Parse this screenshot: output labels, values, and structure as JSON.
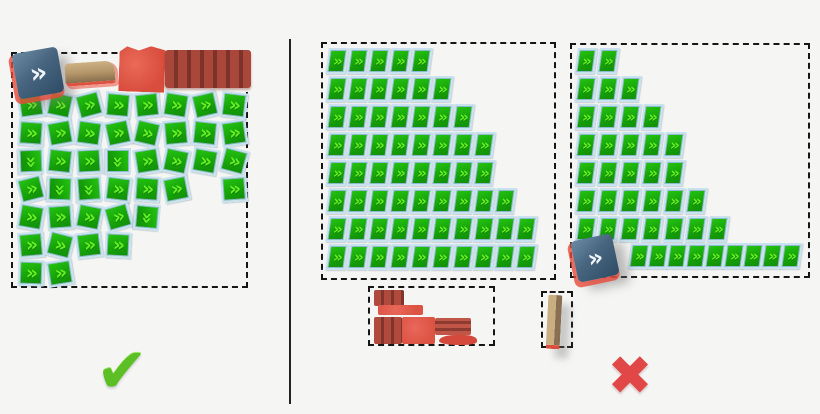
{
  "figure": {
    "width": 820,
    "height": 414,
    "background": "#f5f5f4"
  },
  "divider": {
    "x": 289,
    "y": 39,
    "height": 365,
    "color": "#222222"
  },
  "tile_style": {
    "glyph": "»",
    "green_dark": "#17a30a",
    "green_light": "#66ef24",
    "frame_color": "#c9e3ee",
    "edge_color": "#8fb9cd"
  },
  "icons": {
    "blue_chevron": {
      "glyph": "»",
      "bg_top": "#6a8ba3",
      "bg_bottom": "#2e4c66",
      "fg": "#eef4f8",
      "outline": "#e84a3a"
    },
    "check": {
      "glyph": "✔",
      "color": "#5bbf25"
    },
    "cross": {
      "glyph": "✖",
      "color": "#e14747"
    }
  },
  "left_panel": {
    "meaning": "correct-arrangement",
    "box": {
      "x": 11,
      "y": 52,
      "w": 237,
      "h": 236
    },
    "tile_origin": {
      "x": 5,
      "y": 38
    },
    "step": {
      "x": 29,
      "y": 28
    },
    "specials": [
      {
        "name": "blue-chevron-tile",
        "type": "blue",
        "x": 2,
        "y": -4,
        "w": 46,
        "h": 46,
        "rot": -10
      },
      {
        "name": "tan-wedge",
        "type": "tan",
        "x": 52,
        "y": 8,
        "w": 50,
        "h": 20,
        "rot": -4
      },
      {
        "name": "red-block",
        "type": "red",
        "x": 106,
        "y": -8,
        "w": 46,
        "h": 46,
        "rot": 2
      },
      {
        "name": "red-striped-block",
        "type": "red-striped",
        "x": 152,
        "y": -4,
        "w": 86,
        "h": 38,
        "rot": 0
      }
    ],
    "tiles": [
      [
        0,
        0,
        -8
      ],
      [
        0,
        1,
        4
      ],
      [
        0,
        2,
        88
      ],
      [
        0,
        3,
        -14
      ],
      [
        0,
        4,
        10
      ],
      [
        0,
        5,
        -5
      ],
      [
        0,
        6,
        2
      ],
      [
        1,
        0,
        12
      ],
      [
        1,
        1,
        -10
      ],
      [
        1,
        2,
        6
      ],
      [
        1,
        3,
        92
      ],
      [
        1,
        4,
        -4
      ],
      [
        1,
        5,
        14
      ],
      [
        1,
        6,
        -9
      ],
      [
        2,
        0,
        -15
      ],
      [
        2,
        1,
        8
      ],
      [
        2,
        2,
        -3
      ],
      [
        2,
        3,
        86
      ],
      [
        2,
        4,
        11
      ],
      [
        2,
        5,
        -7
      ],
      [
        3,
        0,
        5
      ],
      [
        3,
        1,
        -12
      ],
      [
        3,
        2,
        90
      ],
      [
        3,
        3,
        7
      ],
      [
        3,
        4,
        -16
      ],
      [
        3,
        5,
        3
      ],
      [
        4,
        0,
        -6
      ],
      [
        4,
        1,
        13
      ],
      [
        4,
        2,
        -9
      ],
      [
        4,
        3,
        4
      ],
      [
        4,
        4,
        95
      ],
      [
        5,
        0,
        9
      ],
      [
        5,
        1,
        -5
      ],
      [
        5,
        2,
        12
      ],
      [
        5,
        3,
        -11
      ],
      [
        6,
        0,
        -13
      ],
      [
        6,
        1,
        6
      ],
      [
        6,
        2,
        10
      ],
      [
        7,
        0,
        7
      ],
      [
        7,
        1,
        -8
      ],
      [
        7,
        2,
        15
      ],
      [
        7,
        3,
        -4
      ]
    ]
  },
  "right_panel_a": {
    "meaning": "incorrect-arrangement-rows",
    "box": {
      "x": 321,
      "y": 42,
      "w": 235,
      "h": 238
    },
    "origin": {
      "x": 4,
      "y": 4
    },
    "step": {
      "x": 21,
      "y": 28
    },
    "rows": [
      5,
      6,
      7,
      8,
      8,
      9,
      10,
      10
    ]
  },
  "right_panel_b": {
    "meaning": "incorrect-arrangement-triangle",
    "box": {
      "x": 570,
      "y": 43,
      "w": 240,
      "h": 235
    },
    "origin": {
      "x": 4,
      "y": 3
    },
    "step": {
      "x": 22,
      "y": 28
    },
    "rows": [
      2,
      3,
      4,
      5,
      5,
      6,
      7
    ],
    "bottom_row": {
      "count": 9,
      "x": 57,
      "y": 198,
      "step": 19
    },
    "icon": {
      "x": 2,
      "y": 192,
      "w": 42,
      "h": 42,
      "rot": -12
    }
  },
  "small_box_bricks": {
    "meaning": "leftover-red-bricks",
    "box": {
      "x": 368,
      "y": 286,
      "w": 127,
      "h": 60
    },
    "bricks": [
      {
        "type": "striped-v",
        "x": 4,
        "y": 2,
        "w": 30,
        "h": 16
      },
      {
        "type": "plain",
        "x": 8,
        "y": 17,
        "w": 45,
        "h": 10
      },
      {
        "type": "striped-v",
        "x": 4,
        "y": 29,
        "w": 28,
        "h": 27
      },
      {
        "type": "plain",
        "x": 32,
        "y": 29,
        "w": 33,
        "h": 27
      },
      {
        "type": "striped-h",
        "x": 65,
        "y": 30,
        "w": 36,
        "h": 17
      },
      {
        "type": "blob",
        "x": 69,
        "y": 47,
        "w": 38,
        "h": 10
      }
    ]
  },
  "small_box_slab": {
    "meaning": "leftover-tan-slab",
    "box": {
      "x": 541,
      "y": 291,
      "w": 32,
      "h": 57
    },
    "slab": {
      "x": 4,
      "y": 2,
      "w": 14,
      "h": 50
    }
  },
  "verdicts": {
    "check": {
      "x": 122,
      "y": 371,
      "size": 62
    },
    "cross": {
      "x": 630,
      "y": 376,
      "size": 54
    }
  }
}
